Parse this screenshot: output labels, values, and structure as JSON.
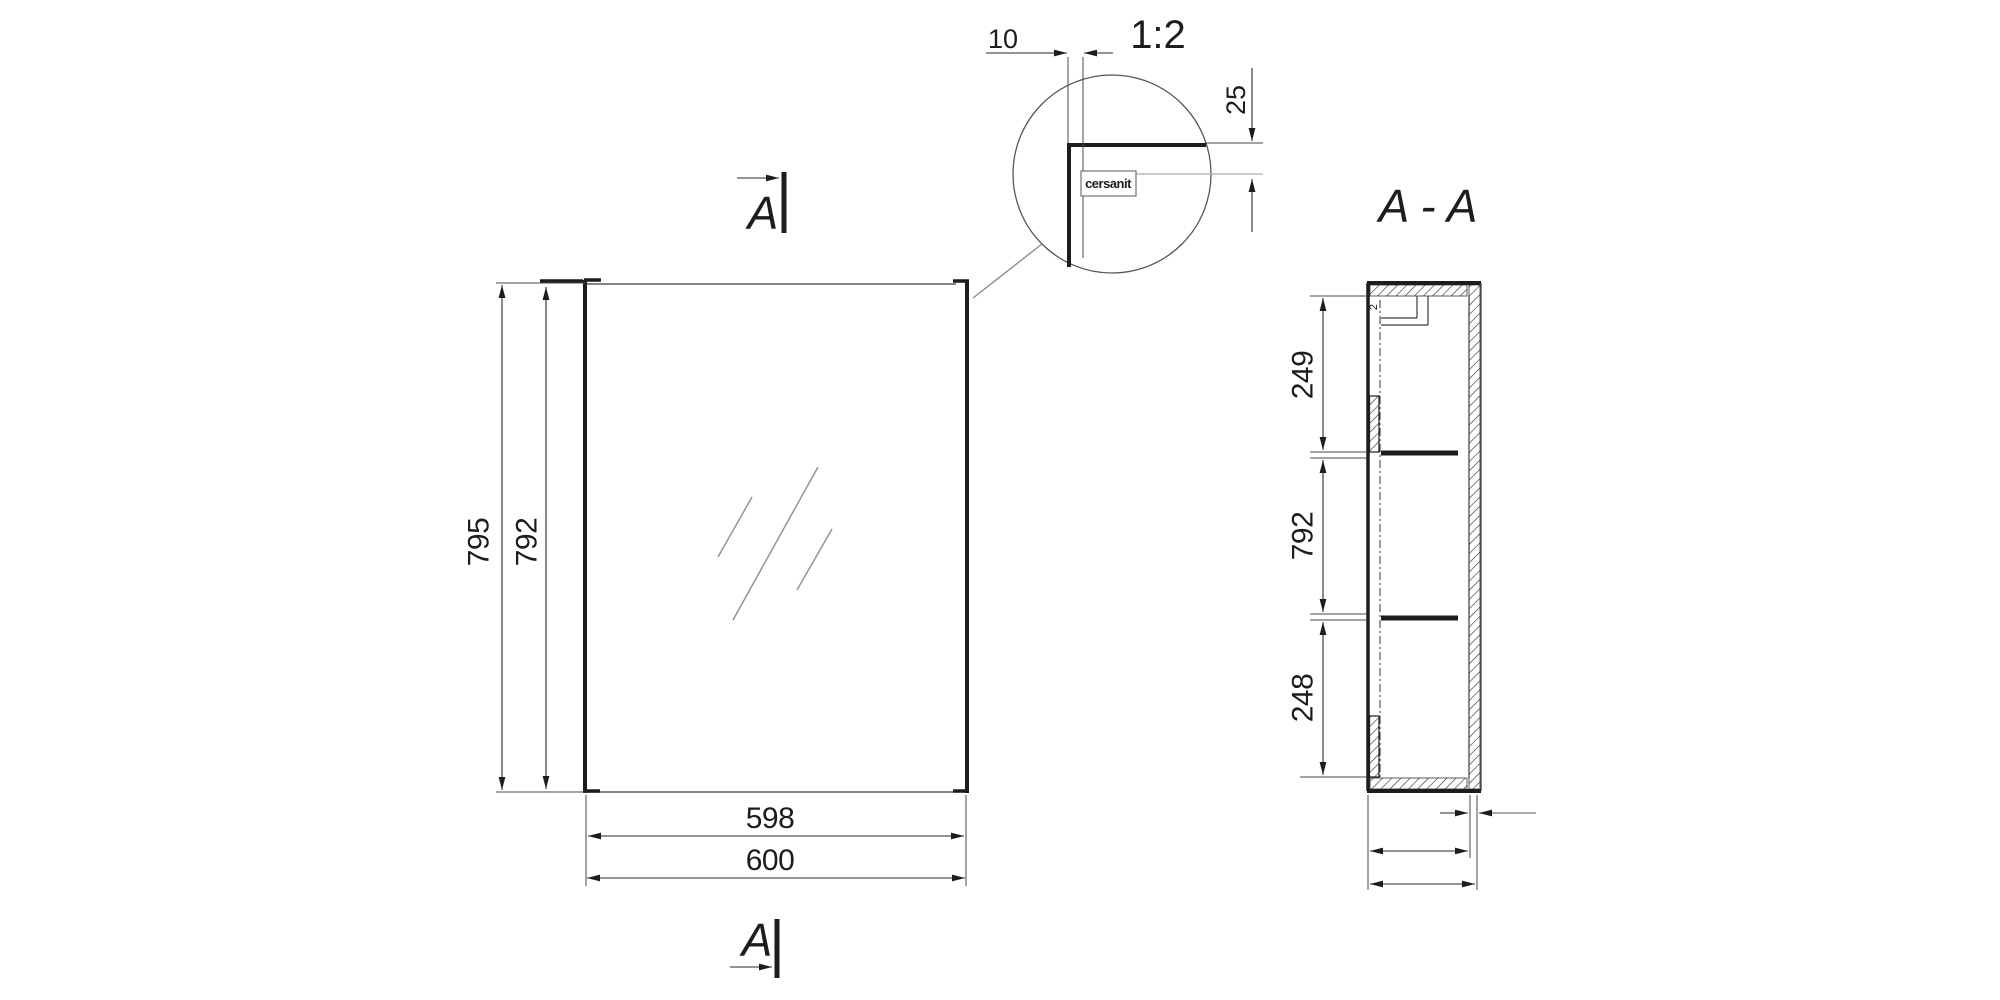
{
  "drawing": {
    "brand_logo": "cersanit",
    "front_view": {
      "section_marker_top": "A",
      "section_marker_bottom": "A",
      "dim_height_overall": "795",
      "dim_height_door": "792",
      "dim_width_glass": "598",
      "dim_width_overall": "600"
    },
    "detail_view": {
      "scale_label": "1:2",
      "dim_edge_offset": "10",
      "dim_top_offset": "25",
      "logo_text": "cersanit"
    },
    "section_view": {
      "title": "A - A",
      "dim_top_to_shelf": "249",
      "dim_middle": "792",
      "dim_shelf_to_bottom": "248",
      "dim_gap": "2"
    },
    "colors": {
      "line": "#1d1d1d",
      "dim_line": "#2a2a2a",
      "gray_line": "#8f8f8f",
      "light_gray_line": "#b8b8b8",
      "background": "#ffffff"
    }
  }
}
